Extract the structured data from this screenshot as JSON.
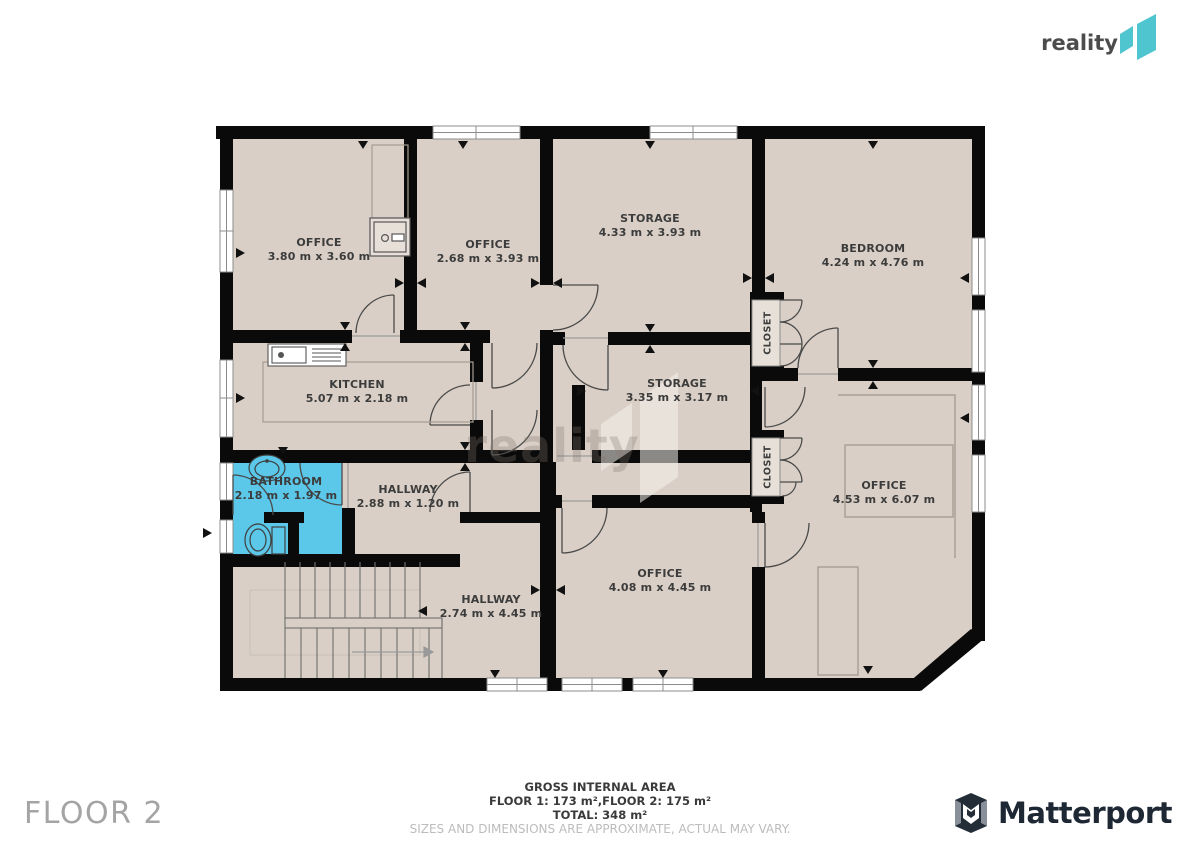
{
  "brand": {
    "name": "reality",
    "mark": "11",
    "teal": "#4ec5cf"
  },
  "watermark": {
    "text": "reality",
    "mark": "11"
  },
  "floor_label": "FLOOR 2",
  "footer": {
    "line1": "GROSS INTERNAL AREA",
    "line2": "FLOOR 1: 173 m²,FLOOR 2: 175 m²",
    "line3": "TOTAL: 348 m²",
    "disclaimer": "SIZES AND DIMENSIONS ARE APPROXIMATE, ACTUAL MAY VARY."
  },
  "matterport_label": "Matterport",
  "colors": {
    "room_fill": "#d9cfc6",
    "wall": "#0a0a0a",
    "bathroom_highlight": "#5bc7e9",
    "window": "#ffffff"
  },
  "rooms": [
    {
      "name": "OFFICE",
      "dims": "3.80 m x 3.60 m"
    },
    {
      "name": "OFFICE",
      "dims": "2.68 m x 3.93 m"
    },
    {
      "name": "STORAGE",
      "dims": "4.33 m x 3.93 m"
    },
    {
      "name": "BEDROOM",
      "dims": "4.24 m x 4.76 m"
    },
    {
      "name": "KITCHEN",
      "dims": "5.07 m x 2.18 m"
    },
    {
      "name": "STORAGE",
      "dims": "3.35 m x 3.17 m"
    },
    {
      "name": "BATHROOM",
      "dims": "2.18 m x 1.97 m"
    },
    {
      "name": "HALLWAY",
      "dims": "2.88 m x 1.20 m"
    },
    {
      "name": "OFFICE",
      "dims": "4.53 m x 6.07 m"
    },
    {
      "name": "OFFICE",
      "dims": "4.08 m x 4.45 m"
    },
    {
      "name": "HALLWAY",
      "dims": "2.74 m x 4.45 m"
    },
    {
      "name": "CLOSET"
    },
    {
      "name": "CLOSET"
    }
  ]
}
